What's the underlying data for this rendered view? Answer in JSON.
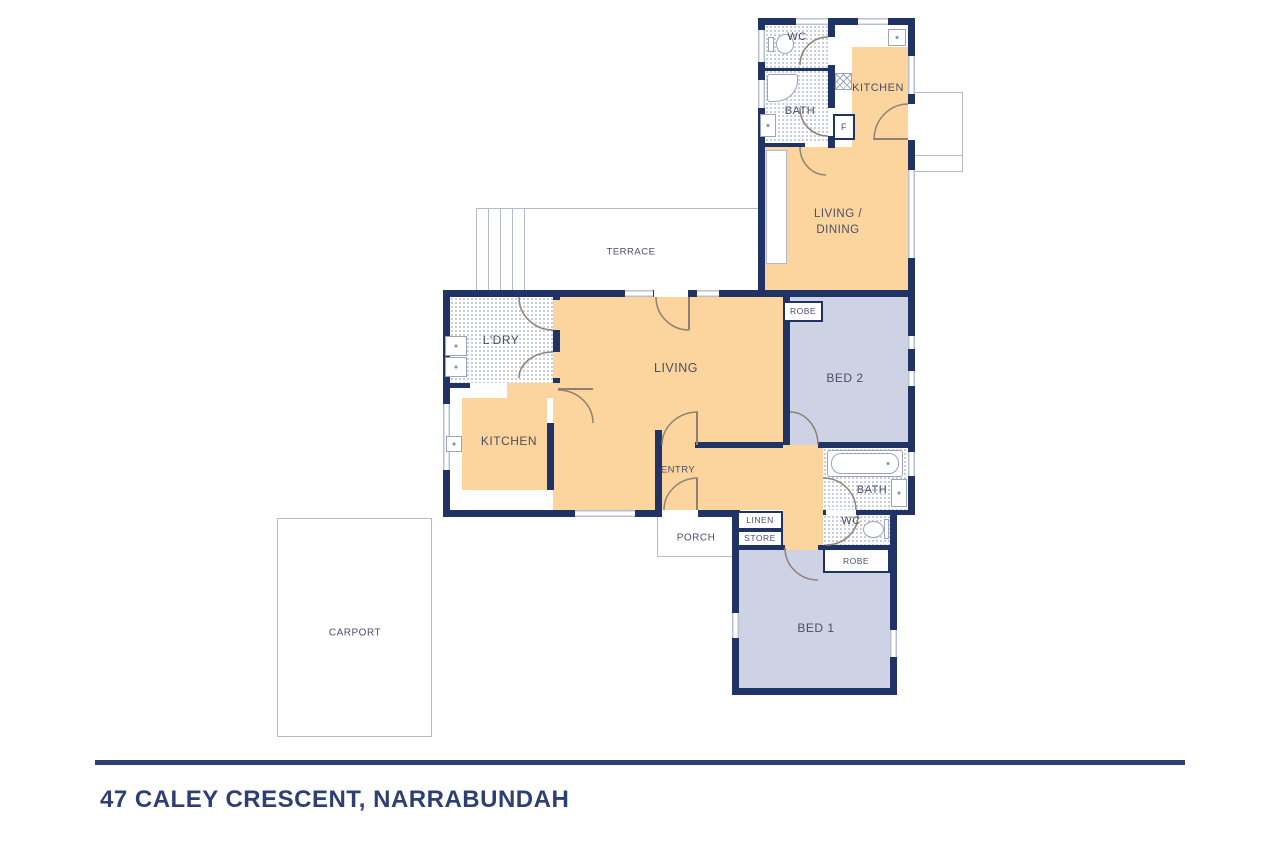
{
  "plan": {
    "colors": {
      "wall": "#1f3464",
      "room_warm": "#fbd59d",
      "room_cool": "#cdd2e4",
      "window_line": "#b9c0d4",
      "tile_dot": "#c3c9db",
      "door_arc": "#8d8271",
      "label": "#494e66",
      "accent": "#2e3f73",
      "outline": "#b3bace"
    },
    "labels": {
      "wc_top": "WC",
      "bath_top": "BATH",
      "kitchen_top": "KITCHEN",
      "fridge": "F",
      "living_dining_line1": "LIVING /",
      "living_dining_line2": "DINING",
      "terrace": "TERRACE",
      "robe_bed2": "ROBE",
      "bed2": "BED 2",
      "laundry": "L'DRY",
      "living": "LIVING",
      "kitchen_main": "KITCHEN",
      "entry": "ENTRY",
      "bath_main": "BATH",
      "wc_main": "WC",
      "linen": "LINEN",
      "store": "STORE",
      "porch": "PORCH",
      "robe_bed1": "ROBE",
      "bed1": "BED 1",
      "carport": "CARPORT"
    },
    "footer": {
      "address": "47 CALEY CRESCENT, NARRABUNDAH"
    }
  }
}
